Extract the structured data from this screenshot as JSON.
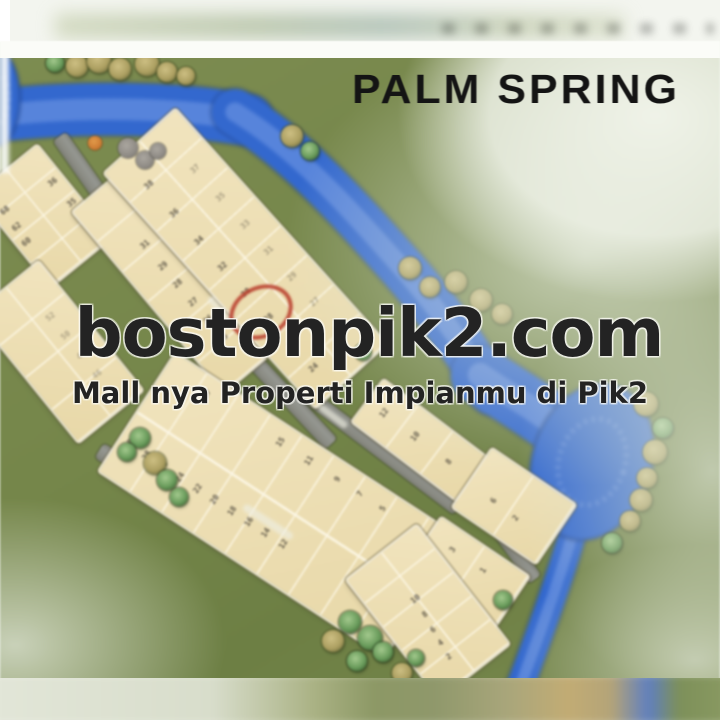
{
  "meta": {
    "description": "Blurry photo of PALM SPRING cluster site plan at PIK2 with watermark overlay",
    "width": 720,
    "height": 720
  },
  "title": {
    "text": "PALM SPRING"
  },
  "watermark": {
    "site": "bostonpik2.com",
    "tagline": "Mall nya Properti Impianmu di Pik2"
  },
  "annotation": {
    "type": "red-circle",
    "circled_lot_number": "28",
    "cx": 257,
    "cy": 308,
    "rx": 29,
    "ry": 22,
    "rot": -27
  },
  "colors": {
    "river": "#3468cc",
    "grass": "#78894e",
    "lot_fill": "#eedfb4",
    "road": "#8d8e86",
    "annotation_red": "#b53e2d",
    "title_text": "#141414",
    "watermark_text": "#232323"
  },
  "map": {
    "blocks": [
      {
        "id": "A",
        "cx": 44,
        "cy": 216,
        "l": 118,
        "w": 78,
        "rot": 51,
        "cols": 4,
        "rows": 2,
        "labels": [
          [
            "36",
            0.32,
            0.14
          ],
          [
            "35",
            0.56,
            0.12
          ],
          [
            "68",
            0.25,
            0.84
          ],
          [
            "62",
            0.42,
            0.86
          ],
          [
            "60",
            0.58,
            0.88
          ]
        ]
      },
      {
        "id": "X",
        "cx": 172,
        "cy": 282,
        "l": 235,
        "w": 62,
        "rot": 50,
        "cols": 6,
        "rows": 1,
        "labels": [
          [
            "31",
            0.3,
            0.45
          ],
          [
            "29",
            0.42,
            0.45
          ],
          [
            "28",
            0.52,
            0.45
          ],
          [
            "27",
            0.62,
            0.45
          ],
          [
            "26",
            0.72,
            0.45
          ],
          [
            "25",
            0.82,
            0.45
          ]
        ]
      },
      {
        "id": "B",
        "cx": 245,
        "cy": 258,
        "l": 315,
        "w": 95,
        "rot": 48,
        "cols": 8,
        "rows": 2,
        "labels": [
          [
            "38",
            0.12,
            0.74
          ],
          [
            "36",
            0.24,
            0.74
          ],
          [
            "34",
            0.36,
            0.74
          ],
          [
            "32",
            0.47,
            0.74
          ],
          [
            "30",
            0.58,
            0.74
          ],
          [
            "28",
            0.69,
            0.74
          ],
          [
            "26",
            0.8,
            0.74
          ],
          [
            "24",
            0.9,
            0.74
          ],
          [
            "37",
            0.18,
            0.26,
            0.5
          ],
          [
            "35",
            0.3,
            0.26,
            0.5
          ],
          [
            "33",
            0.42,
            0.26,
            0.5
          ],
          [
            "31",
            0.53,
            0.26,
            0.5
          ],
          [
            "29",
            0.64,
            0.26,
            0.5
          ],
          [
            "27",
            0.75,
            0.26,
            0.5
          ],
          [
            "25",
            0.86,
            0.26,
            0.5
          ]
        ]
      },
      {
        "id": "C",
        "cx": 58,
        "cy": 352,
        "l": 165,
        "w": 82,
        "rot": 51,
        "cols": 4,
        "rows": 2,
        "labels": [
          [
            "52",
            0.3,
            0.3,
            0.45
          ],
          [
            "50",
            0.45,
            0.3,
            0.45
          ],
          [
            "48",
            0.6,
            0.3,
            0.45
          ],
          [
            "46",
            0.75,
            0.3,
            0.45
          ]
        ]
      },
      {
        "id": "D",
        "cx": 280,
        "cy": 505,
        "l": 340,
        "w": 140,
        "rot": 33,
        "cols": 9,
        "rows": 2,
        "labels": [
          [
            "17",
            0.14,
            0.12
          ],
          [
            "15",
            0.4,
            0.12
          ],
          [
            "11",
            0.5,
            0.12
          ],
          [
            "9",
            0.6,
            0.12
          ],
          [
            "7",
            0.68,
            0.12
          ],
          [
            "5",
            0.76,
            0.12
          ],
          [
            "30",
            0.03,
            0.72
          ],
          [
            "28",
            0.09,
            0.72
          ],
          [
            "26",
            0.15,
            0.72
          ],
          [
            "24",
            0.21,
            0.72
          ],
          [
            "22",
            0.27,
            0.72
          ],
          [
            "20",
            0.33,
            0.72
          ],
          [
            "18",
            0.39,
            0.72
          ],
          [
            "16",
            0.45,
            0.72
          ],
          [
            "14",
            0.51,
            0.72
          ],
          [
            "12",
            0.57,
            0.72
          ]
        ]
      },
      {
        "id": "E",
        "cx": 420,
        "cy": 440,
        "l": 130,
        "w": 52,
        "rot": 37,
        "cols": 3,
        "rows": 1,
        "labels": [
          [
            "12",
            0.15,
            0.5
          ],
          [
            "10",
            0.45,
            0.5
          ],
          [
            "8",
            0.78,
            0.5
          ]
        ]
      },
      {
        "id": "F",
        "cx": 514,
        "cy": 506,
        "l": 100,
        "w": 70,
        "rot": 34,
        "cols": 2,
        "rows": 1,
        "labels": [
          [
            "6",
            0.3,
            0.6
          ],
          [
            "2",
            0.58,
            0.63
          ]
        ]
      },
      {
        "id": "G",
        "cx": 467,
        "cy": 573,
        "l": 105,
        "w": 62,
        "rot": 34,
        "cols": 2,
        "rows": 1,
        "labels": [
          [
            "3",
            0.26,
            0.33
          ],
          [
            "1",
            0.61,
            0.33
          ]
        ]
      },
      {
        "id": "H",
        "cx": 428,
        "cy": 612,
        "l": 150,
        "w": 88,
        "rot": 52,
        "cols": 5,
        "rows": 2,
        "labels": [
          [
            "10",
            0.38,
            0.52
          ],
          [
            "8",
            0.5,
            0.55
          ],
          [
            "6",
            0.61,
            0.58
          ],
          [
            "4",
            0.71,
            0.6
          ],
          [
            "2",
            0.82,
            0.62
          ]
        ]
      }
    ],
    "roads": [
      {
        "id": "Ra",
        "cx": 132,
        "cy": 241,
        "l": 255,
        "w": 16,
        "rot": 55
      },
      {
        "id": "Rb",
        "cx": 220,
        "cy": 325,
        "l": 325,
        "w": 16,
        "rot": 47
      },
      {
        "id": "Rc",
        "cx": 262,
        "cy": 552,
        "l": 385,
        "w": 17,
        "rot": 32
      },
      {
        "id": "Rd",
        "cx": 378,
        "cy": 448,
        "l": 200,
        "w": 15,
        "rot": 37
      },
      {
        "id": "Re",
        "cx": 485,
        "cy": 510,
        "l": 170,
        "w": 15,
        "rot": 54
      }
    ],
    "hedges": [
      {
        "cx": 253,
        "cy": 424,
        "l": 150,
        "w": 22,
        "rot": 41
      }
    ],
    "road_labels": [
      {
        "cx": 268,
        "cy": 522,
        "l": 58,
        "w": 8,
        "rot": 33
      },
      {
        "cx": 333,
        "cy": 416,
        "l": 34,
        "w": 7,
        "rot": 37
      },
      {
        "cx": 222,
        "cy": 312,
        "l": 40,
        "w": 7,
        "rot": 49
      }
    ],
    "river": {
      "strokes": [
        {
          "d": "M -20 118 C 60 106 170 106 248 120",
          "w": 52
        },
        {
          "d": "M 235 112 C 300 152 352 212 402 268 C 432 302 462 342 492 392",
          "w": 46
        },
        {
          "d": "M 480 375 C 520 402 555 420 585 452",
          "w": 58
        },
        {
          "d": "M 575 525 C 562 572 543 625 518 692",
          "w": 27
        }
      ],
      "blobs": [
        {
          "cx": 592,
          "cy": 462,
          "rx": 60,
          "ry": 80,
          "rot": 18
        },
        {
          "cx": -6,
          "cy": 98,
          "rx": 26,
          "ry": 50,
          "rot": 0
        }
      ]
    },
    "trees": [
      [
        55,
        63,
        9,
        "g"
      ],
      [
        77,
        66,
        11,
        "k"
      ],
      [
        99,
        61,
        12,
        "k"
      ],
      [
        120,
        69,
        11,
        "k"
      ],
      [
        147,
        64,
        12,
        "k"
      ],
      [
        167,
        72,
        10,
        "k"
      ],
      [
        186,
        76,
        9,
        "k"
      ],
      [
        292,
        136,
        11,
        "k"
      ],
      [
        310,
        151,
        9,
        "g"
      ],
      [
        128,
        148,
        10,
        "r"
      ],
      [
        145,
        160,
        9,
        "r"
      ],
      [
        158,
        151,
        8,
        "r"
      ],
      [
        95,
        143,
        7,
        "o"
      ],
      [
        410,
        268,
        11,
        "k"
      ],
      [
        430,
        287,
        10,
        "k"
      ],
      [
        456,
        282,
        11,
        "k"
      ],
      [
        481,
        300,
        11,
        "k"
      ],
      [
        502,
        314,
        10,
        "k"
      ],
      [
        363,
        352,
        8,
        "g"
      ],
      [
        646,
        404,
        12,
        "k"
      ],
      [
        663,
        428,
        10,
        "g"
      ],
      [
        655,
        452,
        12,
        "k"
      ],
      [
        647,
        478,
        10,
        "k"
      ],
      [
        641,
        500,
        11,
        "k"
      ],
      [
        630,
        521,
        10,
        "k"
      ],
      [
        612,
        543,
        10,
        "g"
      ],
      [
        140,
        438,
        10,
        "g"
      ],
      [
        127,
        452,
        9,
        "g"
      ],
      [
        155,
        463,
        11,
        "k"
      ],
      [
        167,
        480,
        10,
        "g"
      ],
      [
        179,
        497,
        9,
        "g"
      ],
      [
        350,
        622,
        11,
        "g"
      ],
      [
        370,
        638,
        12,
        "g"
      ],
      [
        333,
        641,
        11,
        "k"
      ],
      [
        357,
        661,
        10,
        "g"
      ],
      [
        383,
        652,
        10,
        "g"
      ],
      [
        402,
        673,
        10,
        "k"
      ],
      [
        416,
        658,
        8,
        "g"
      ],
      [
        503,
        600,
        9,
        "g"
      ]
    ]
  }
}
